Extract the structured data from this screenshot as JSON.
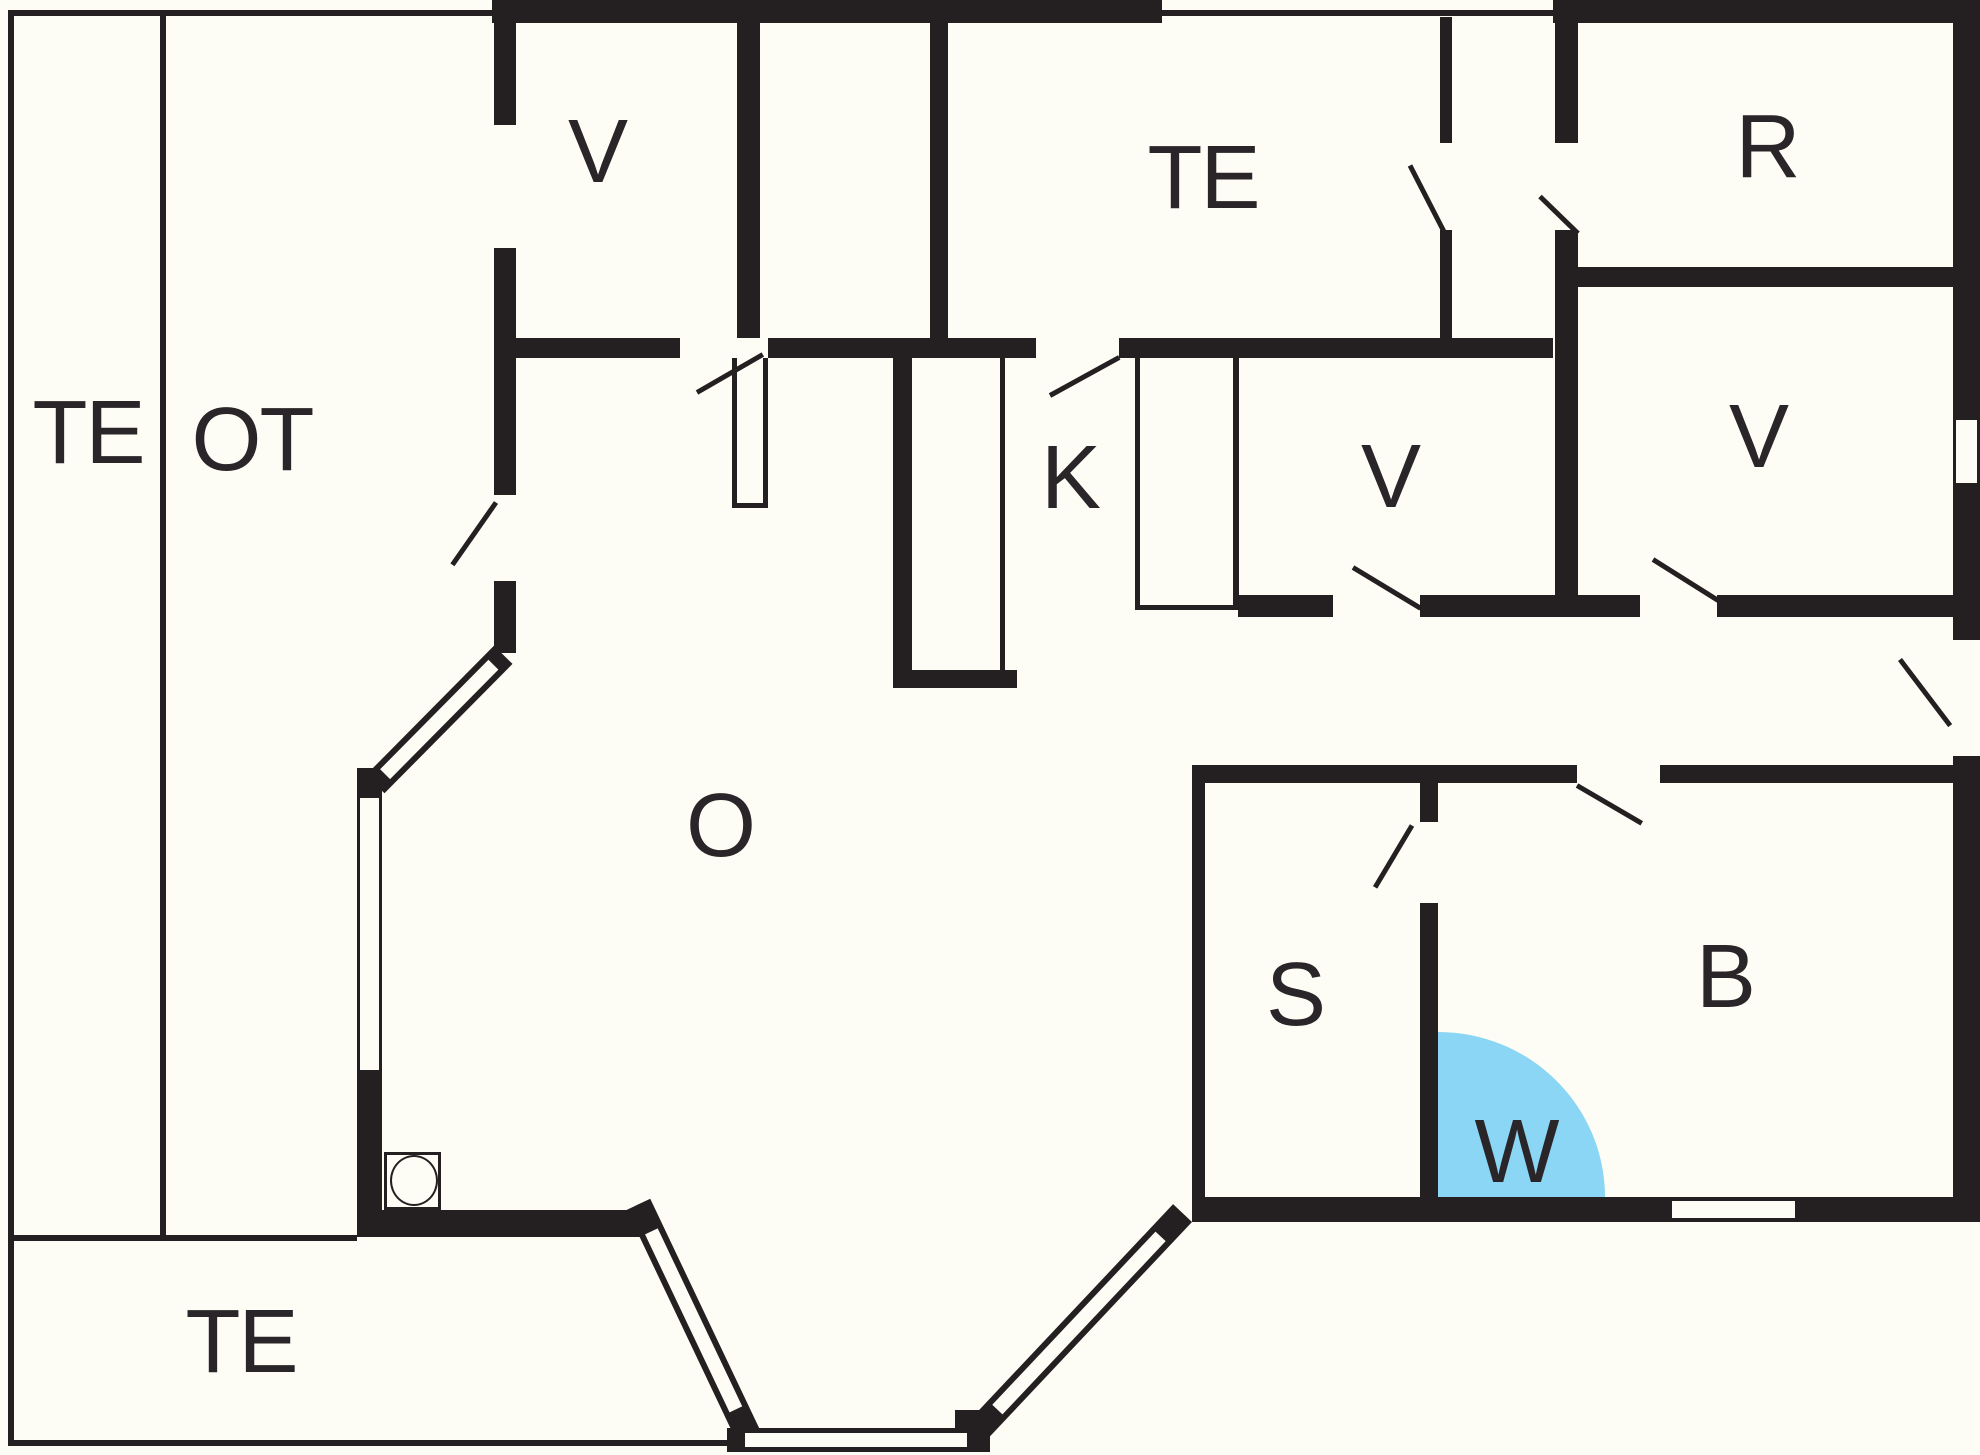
{
  "title": "Floor plan",
  "colors": {
    "wall": "#241f21",
    "background": "#fdfdf6",
    "label": "#2a2528",
    "shower": "#8ad6f4"
  },
  "rooms": [
    {
      "name": "terrace-left",
      "label": "TE"
    },
    {
      "name": "covered-terrace",
      "label": "OT"
    },
    {
      "name": "bedroom-top",
      "label": "V"
    },
    {
      "name": "terrace-top",
      "label": "TE"
    },
    {
      "name": "storage",
      "label": "R"
    },
    {
      "name": "kitchen",
      "label": "K"
    },
    {
      "name": "bedroom-middle",
      "label": "V"
    },
    {
      "name": "bedroom-right",
      "label": "V"
    },
    {
      "name": "living-room",
      "label": "O"
    },
    {
      "name": "sauna",
      "label": "S"
    },
    {
      "name": "wet-room",
      "label": "W"
    },
    {
      "name": "bathroom",
      "label": "B"
    },
    {
      "name": "terrace-bottom",
      "label": "TE"
    }
  ]
}
